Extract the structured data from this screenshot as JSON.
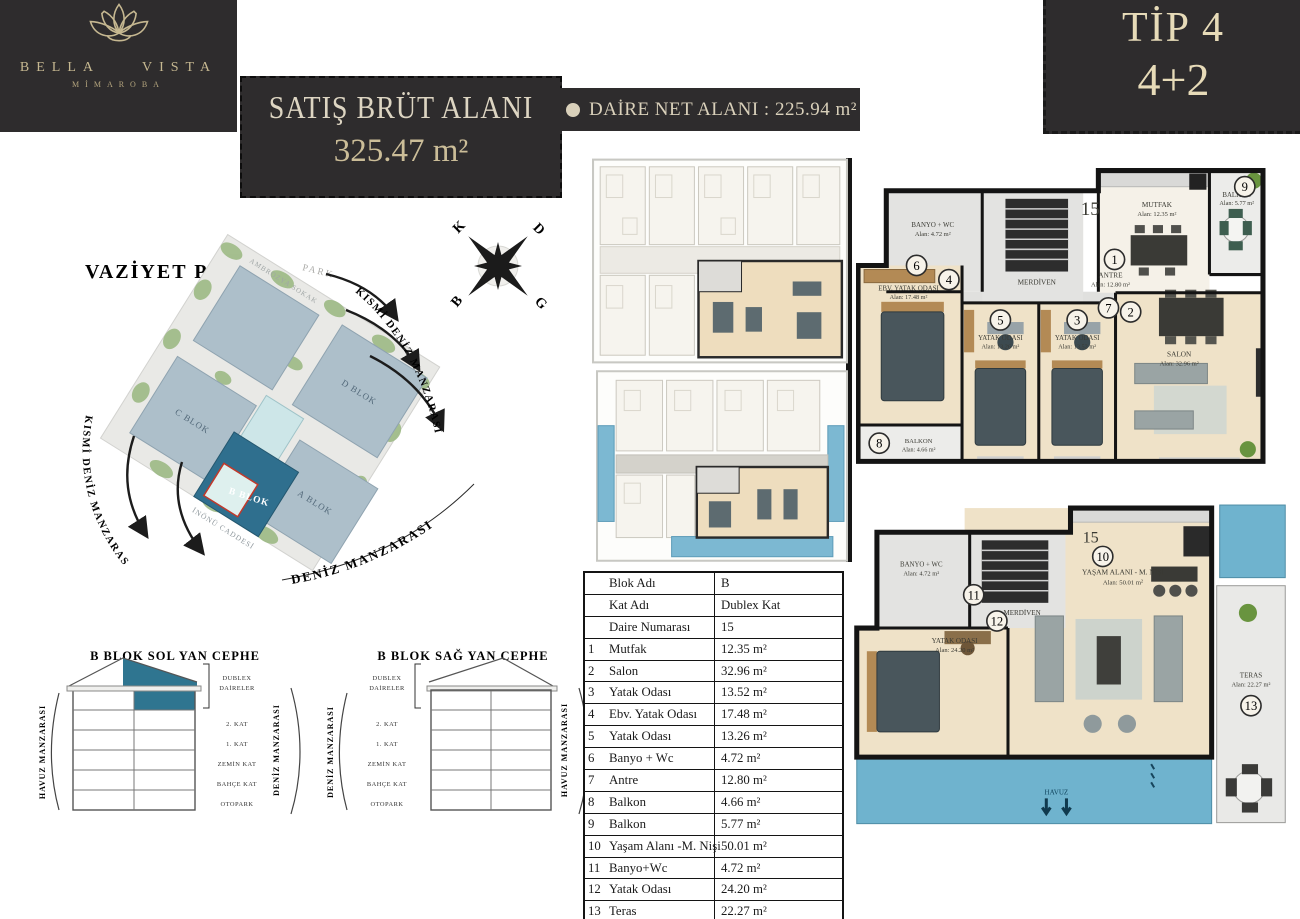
{
  "brand": {
    "left": "BELLA",
    "right": "VISTA",
    "subtitle": "MİMAROBA"
  },
  "header": {
    "gross_label": "SATIŞ BRÜT ALANI",
    "gross_value": "325.47 m²",
    "net_label": "DAİRE NET ALANI : 225.94 m²",
    "type_title": "TİP 4",
    "type_rooms": "4+2"
  },
  "site_plan": {
    "title": "VAZİYET PLANI",
    "park_label": "PARK",
    "view_right": "KISMİ DENİZ MANZARASI",
    "view_left": "KISMİ DENİZ MANZARASI",
    "view_bottom": "DENİZ MANZARASI",
    "street_top": "AMBROZYA SOKAK",
    "street_bottom": "İNÖNÜ CADDESİ",
    "blocks": {
      "a": "A BLOK",
      "b": "B BLOK",
      "c": "C BLOK",
      "d": "D BLOK"
    },
    "compass": {
      "n": "K",
      "e": "D",
      "w": "B",
      "s": "G"
    }
  },
  "elevations": {
    "left": {
      "title": "B BLOK SOL YAN CEPHE",
      "side_left": "HAVUZ MANZARASI",
      "side_right": "DENİZ MANZARASI"
    },
    "right": {
      "title": "B BLOK SAĞ YAN CEPHE",
      "side_left": "DENİZ MANZARASI",
      "side_right": "HAVUZ MANZARASI"
    },
    "duplex_label_1": "DUBLEX",
    "duplex_label_2": "DAİRELER",
    "floors": [
      "2. KAT",
      "1. KAT",
      "ZEMİN KAT",
      "BAHÇE KAT",
      "OTOPARK"
    ]
  },
  "table": {
    "info": [
      {
        "label": "Blok Adı",
        "value": "B"
      },
      {
        "label": "Kat Adı",
        "value": "Dublex Kat"
      },
      {
        "label": "Daire Numarası",
        "value": "15"
      }
    ],
    "rooms": [
      {
        "no": "1",
        "name": "Mutfak",
        "area": "12.35 m²"
      },
      {
        "no": "2",
        "name": "Salon",
        "area": "32.96 m²"
      },
      {
        "no": "3",
        "name": "Yatak Odası",
        "area": "13.52 m²"
      },
      {
        "no": "4",
        "name": "Ebv. Yatak Odası",
        "area": "17.48 m²"
      },
      {
        "no": "5",
        "name": "Yatak Odası",
        "area": "13.26 m²"
      },
      {
        "no": "6",
        "name": "Banyo + Wc",
        "area": "4.72  m²"
      },
      {
        "no": "7",
        "name": "Antre",
        "area": "12.80 m²"
      },
      {
        "no": "8",
        "name": "Balkon",
        "area": "4.66 m²"
      },
      {
        "no": "9",
        "name": "Balkon",
        "area": "5.77  m²"
      },
      {
        "no": "10",
        "name": "Yaşam Alanı -M. Nişi",
        "area": "50.01 m²"
      },
      {
        "no": "11",
        "name": "Banyo+Wc",
        "area": "4.72 m²"
      },
      {
        "no": "12",
        "name": "Yatak Odası",
        "area": "24.20 m²"
      },
      {
        "no": "13",
        "name": "Teras",
        "area": "22.27 m²"
      }
    ]
  },
  "plan_upper": {
    "unit": "15",
    "rooms": {
      "banyo": {
        "no": "6",
        "name": "BANYO + WC",
        "area": "Alan: 4.72 m²"
      },
      "merdiven": {
        "name": "MERDİVEN"
      },
      "antre": {
        "no": "7",
        "name": "ANTRE",
        "area": "Alan: 12.80 m²"
      },
      "mutfak": {
        "no": "1",
        "name": "MUTFAK",
        "area": "Alan: 12.35 m²"
      },
      "balkon9": {
        "no": "9",
        "name": "BALKON",
        "area": "Alan: 5.77 m²"
      },
      "ebv": {
        "no": "4",
        "name": "EBV. YATAK ODASI",
        "area": "Alan: 17.48 m²"
      },
      "yatak5": {
        "no": "5",
        "name": "YATAK ODASI",
        "area": "Alan: 13.26 m²"
      },
      "yatak3": {
        "no": "3",
        "name": "YATAK ODASI",
        "area": "Alan: 13.52 m²"
      },
      "salon": {
        "no": "2",
        "name": "SALON",
        "area": "Alan: 32.96 m²"
      },
      "balkon8": {
        "no": "8",
        "name": "BALKON",
        "area": "Alan: 4.66 m²"
      }
    }
  },
  "plan_lower": {
    "unit": "15",
    "rooms": {
      "banyo": {
        "no": "11",
        "name": "BANYO + WC",
        "area": "Alan: 4.72 m²"
      },
      "merdiven": {
        "name": "MERDİVEN"
      },
      "yasam": {
        "no": "10",
        "name": "YAŞAM ALANI - M. NİŞİ",
        "area": "Alan: 50.01 m²"
      },
      "yatak12": {
        "no": "12",
        "name": "YATAK ODASI",
        "area": "Alan: 24.20 m²"
      },
      "teras": {
        "no": "13",
        "name": "TERAS",
        "area": "Alan: 22.27 m²"
      },
      "havuz": "HAVUZ"
    }
  }
}
